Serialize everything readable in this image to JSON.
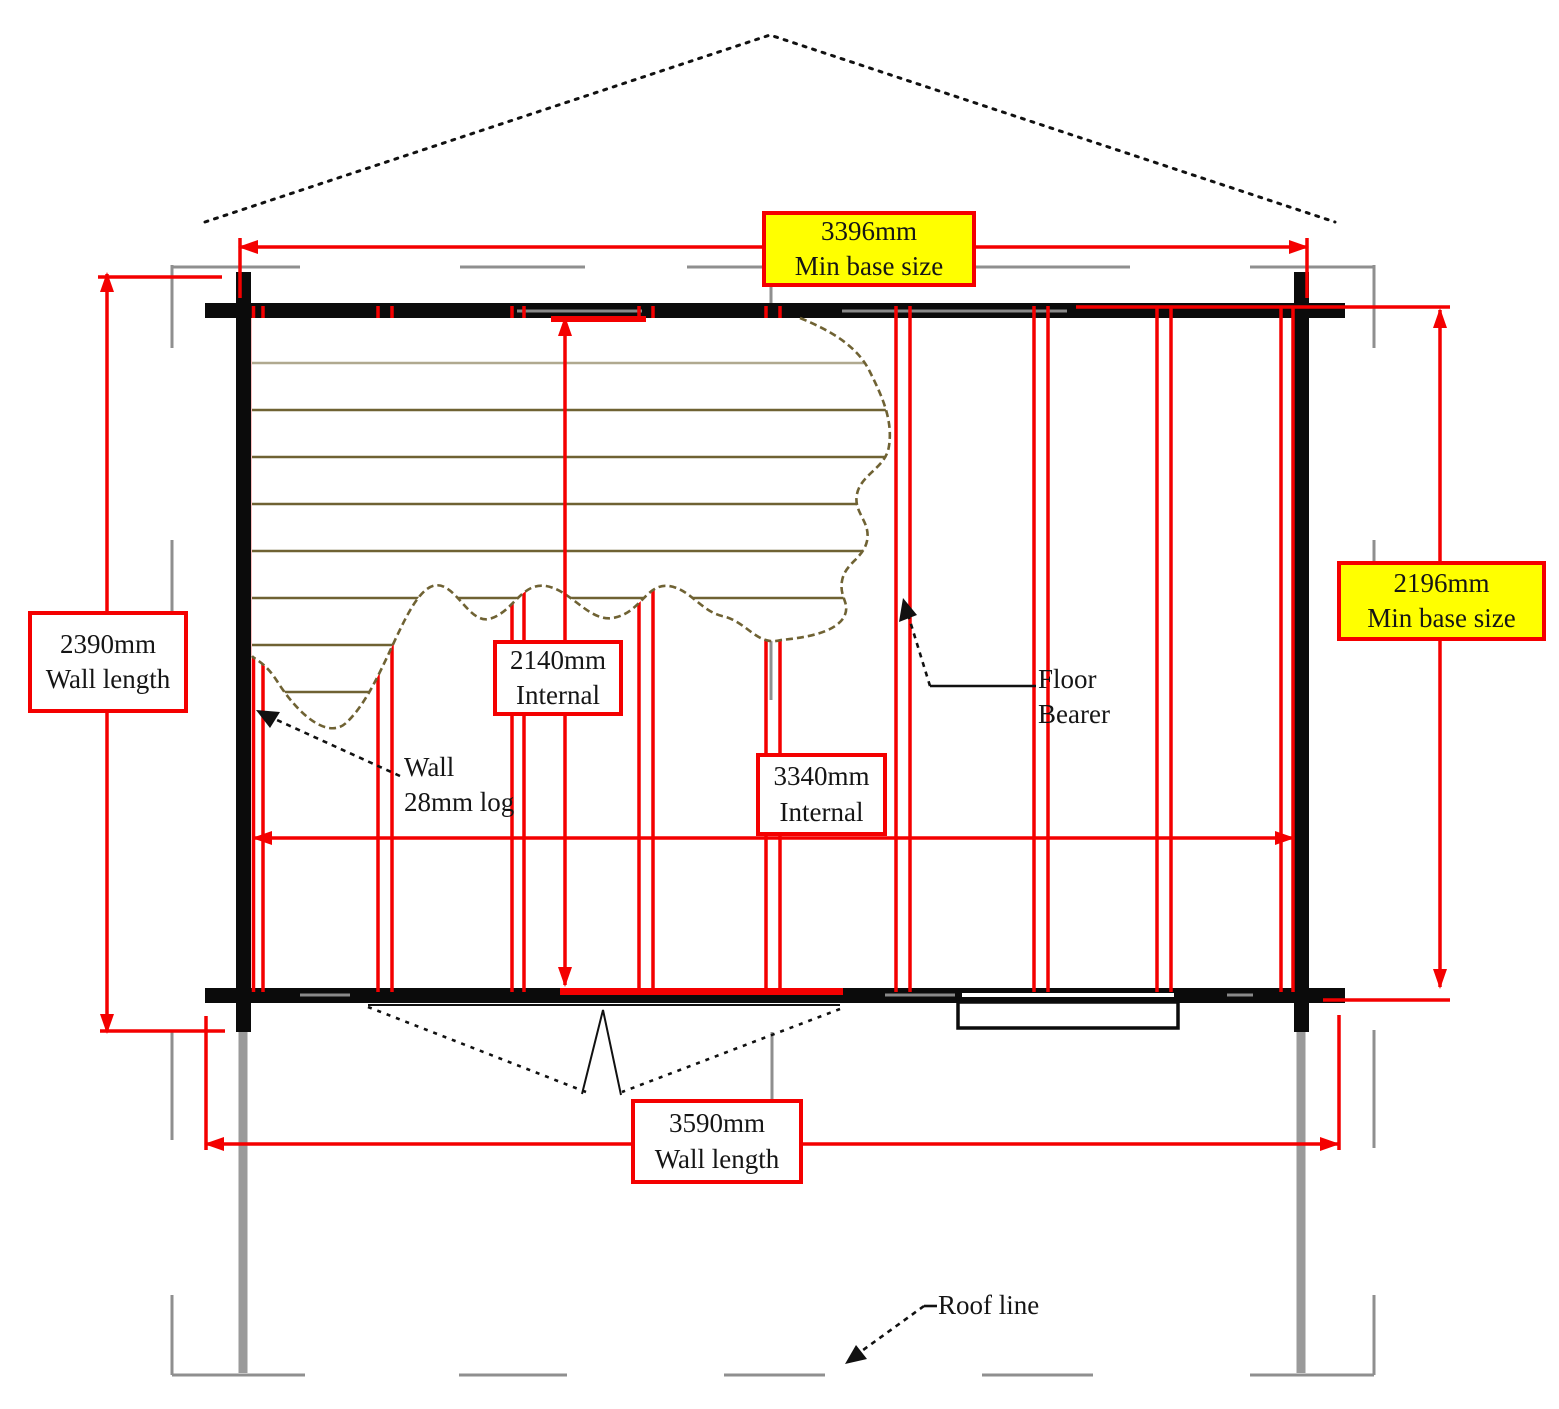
{
  "labels": {
    "base_width": {
      "value": "3396mm",
      "caption": "Min base size"
    },
    "base_depth": {
      "value": "2196mm",
      "caption": "Min base size"
    },
    "wall_left": {
      "value": "2390mm",
      "caption": "Wall length"
    },
    "wall_bottom": {
      "value": "3590mm",
      "caption": "Wall length"
    },
    "internal_width": {
      "value": "2140mm",
      "caption": "Internal"
    },
    "internal_length": {
      "value": "3340mm",
      "caption": "Internal"
    },
    "wall_note": {
      "line1": "Wall",
      "line2": "28mm log"
    },
    "floor_bearer_note": {
      "line1": "Floor",
      "line2": "Bearer"
    },
    "roof_line_note": "Roof line"
  },
  "colors": {
    "dim": "#f40000",
    "wall": "#0b0b0b",
    "roof": "#8f8f8f",
    "board": "#6f6233",
    "highlight": "#ffff00",
    "ink": "#111111"
  }
}
